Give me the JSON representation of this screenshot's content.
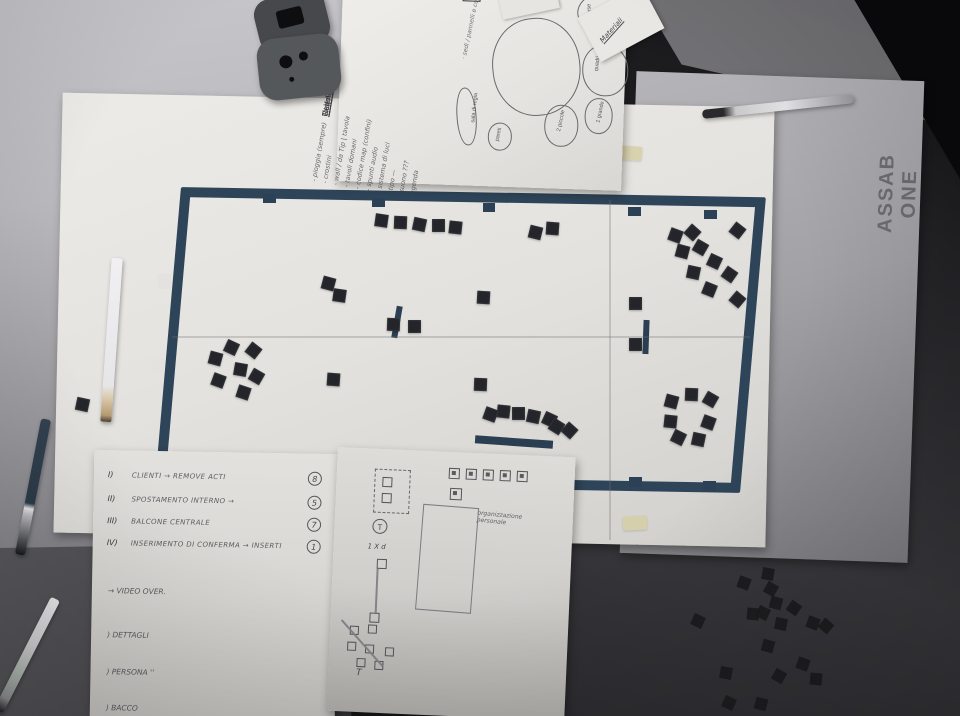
{
  "scene": {
    "description": "photo of exhibition floor-plan mockup papers on a work table",
    "venue_label": "ASSAB ONE"
  },
  "colors": {
    "plan_border": "#2e4458",
    "chip": "#23252a",
    "paper": "#e7e5e1",
    "gray_sheet": "#a2a1a5",
    "table_light": "#c9c8cc",
    "floor_dark": "#2c2b2f"
  },
  "plan": {
    "chips": [
      [
        375,
        214,
        8
      ],
      [
        394,
        216,
        2
      ],
      [
        413,
        218,
        12
      ],
      [
        432,
        219,
        0
      ],
      [
        449,
        221,
        6
      ],
      [
        529,
        226,
        14
      ],
      [
        546,
        222,
        4
      ],
      [
        669,
        229,
        20
      ],
      [
        686,
        226,
        42
      ],
      [
        731,
        224,
        38
      ],
      [
        676,
        245,
        15
      ],
      [
        694,
        241,
        30
      ],
      [
        708,
        255,
        25
      ],
      [
        687,
        266,
        12
      ],
      [
        723,
        268,
        35
      ],
      [
        703,
        283,
        22
      ],
      [
        731,
        293,
        40
      ],
      [
        322,
        277,
        15
      ],
      [
        333,
        289,
        8
      ],
      [
        477,
        291,
        3
      ],
      [
        629,
        297,
        0
      ],
      [
        387,
        318,
        2
      ],
      [
        408,
        320,
        0
      ],
      [
        225,
        341,
        25
      ],
      [
        247,
        344,
        38
      ],
      [
        209,
        352,
        15
      ],
      [
        234,
        363,
        10
      ],
      [
        250,
        370,
        30
      ],
      [
        212,
        374,
        20
      ],
      [
        237,
        386,
        18
      ],
      [
        327,
        373,
        4
      ],
      [
        629,
        338,
        0
      ],
      [
        474,
        378,
        2
      ],
      [
        484,
        408,
        20
      ],
      [
        497,
        405,
        6
      ],
      [
        512,
        407,
        0
      ],
      [
        527,
        410,
        12
      ],
      [
        543,
        413,
        25
      ],
      [
        550,
        420,
        32
      ],
      [
        563,
        424,
        42
      ],
      [
        492,
        462,
        10
      ],
      [
        510,
        459,
        0
      ],
      [
        524,
        458,
        6
      ],
      [
        549,
        475,
        0
      ],
      [
        665,
        395,
        15
      ],
      [
        685,
        388,
        2
      ],
      [
        704,
        393,
        30
      ],
      [
        664,
        415,
        6
      ],
      [
        702,
        416,
        20
      ],
      [
        672,
        431,
        26
      ],
      [
        692,
        433,
        12
      ],
      [
        76,
        398,
        12
      ]
    ],
    "bars": [
      [
        394,
        306,
        6,
        32,
        10
      ],
      [
        643,
        320,
        6,
        34,
        2
      ],
      [
        475,
        438,
        78,
        8,
        4
      ]
    ],
    "notches": [
      [
        263,
        194,
        13,
        9
      ],
      [
        372,
        198,
        13,
        9
      ],
      [
        483,
        203,
        12,
        9
      ],
      [
        628,
        207,
        13,
        9
      ],
      [
        704,
        210,
        13,
        9
      ],
      [
        629,
        477,
        13,
        10
      ],
      [
        703,
        481,
        13,
        10
      ],
      [
        323,
        463,
        8,
        20
      ],
      [
        323,
        475,
        26,
        8
      ]
    ],
    "gaps": [
      [
        158,
        274,
        13,
        15
      ],
      [
        151,
        358,
        13,
        15
      ]
    ],
    "seams": [
      [
        609,
        200,
        2,
        340
      ],
      [
        172,
        336,
        578,
        2
      ]
    ],
    "tapes": [
      [
        616,
        146,
        26,
        14,
        4
      ],
      [
        320,
        482,
        20,
        26,
        2
      ],
      [
        623,
        516,
        24,
        14,
        -3
      ]
    ]
  },
  "floor_chips": [
    [
      738,
      577,
      20
    ],
    [
      762,
      568,
      10
    ],
    [
      765,
      583,
      30
    ],
    [
      770,
      597,
      15
    ],
    [
      747,
      608,
      5
    ],
    [
      757,
      607,
      25
    ],
    [
      788,
      602,
      35
    ],
    [
      775,
      618,
      12
    ],
    [
      807,
      617,
      20
    ],
    [
      820,
      620,
      40
    ],
    [
      692,
      615,
      25
    ],
    [
      762,
      640,
      15
    ],
    [
      720,
      667,
      10
    ],
    [
      773,
      670,
      30
    ],
    [
      797,
      658,
      20
    ],
    [
      810,
      673,
      5
    ],
    [
      723,
      697,
      25
    ],
    [
      755,
      698,
      15
    ]
  ],
  "notes_sheet": {
    "headings": [
      "Titolo",
      "Calendario",
      "Regole"
    ],
    "lines": [
      "- pioggia (sempre)",
      "- crostini",
      "- wall / da Tip | tavola",
      "- tavoli domani",
      "- codice map (confini)",
      "- spunti audio",
      "- sistema di luci",
      "- tipo —",
      "- suono ???",
      "- agenda"
    ],
    "side_note": "· sedi / pannelli e copie",
    "corner_label": "Materiali",
    "bubbles": [
      {
        "x": 152,
        "y": 52,
        "w": 88,
        "h": 98,
        "r": -8,
        "label": ""
      },
      {
        "x": 235,
        "y": 26,
        "w": 42,
        "h": 36,
        "r": -15,
        "label": "forse"
      },
      {
        "x": 242,
        "y": 76,
        "w": 46,
        "h": 52,
        "r": -5,
        "label": "quadri"
      },
      {
        "x": 206,
        "y": 138,
        "w": 34,
        "h": 42,
        "r": 0,
        "label": "2 piccole"
      },
      {
        "x": 246,
        "y": 130,
        "w": 28,
        "h": 36,
        "r": 0,
        "label": "1 grande"
      },
      {
        "x": 118,
        "y": 124,
        "w": 20,
        "h": 58,
        "r": -6,
        "label": "sala di regia"
      },
      {
        "x": 150,
        "y": 158,
        "w": 24,
        "h": 28,
        "r": 0,
        "label": "pareti"
      }
    ]
  },
  "list_sheet": {
    "items": [
      {
        "n": "I)",
        "t": "CLIENTI → REMOVE ACTI",
        "b": "8",
        "y": 20
      },
      {
        "n": "II)",
        "t": "SPOSTAMENTO INTERNO →",
        "b": "5",
        "y": 44
      },
      {
        "n": "III)",
        "t": "BALCONE CENTRALE",
        "b": "7",
        "y": 66
      },
      {
        "n": "IV)",
        "t": "INSERIMENTO DI CONFERMA → INSERTI",
        "b": "1",
        "y": 88
      }
    ],
    "extras": [
      {
        "text": "→ VIDEO OVER.",
        "y": 136
      },
      {
        "text": ") DETTAGLI",
        "y": 180
      },
      {
        "text": ") PERSONA ''",
        "y": 217
      },
      {
        "text": ") BACCO",
        "y": 253
      }
    ]
  },
  "sketch_sheet": {
    "label": "organizzazione personale",
    "circle_mark": "T",
    "count_note": "1 X d",
    "t_mark": "T",
    "top_row_squares": [
      [
        112,
        16
      ],
      [
        129,
        16
      ],
      [
        146,
        16
      ],
      [
        163,
        16
      ],
      [
        180,
        16
      ]
    ],
    "plus_square": [
      114,
      36
    ],
    "dashed_box": [
      38,
      20,
      36,
      44
    ],
    "dash_inner_squares": [
      [
        46,
        28
      ],
      [
        46,
        44
      ]
    ],
    "circle_pos": [
      38,
      70
    ],
    "line_squares": [
      [
        44,
        110
      ],
      [
        39,
        164
      ]
    ],
    "rect": [
      86,
      54,
      56,
      106
    ],
    "scatter_squares": [
      [
        20,
        178
      ],
      [
        38,
        176
      ],
      [
        18,
        194
      ],
      [
        36,
        196
      ],
      [
        56,
        198
      ],
      [
        28,
        210
      ],
      [
        46,
        212
      ]
    ],
    "scatter_line": [
      12,
      172,
      62,
      46
    ]
  }
}
